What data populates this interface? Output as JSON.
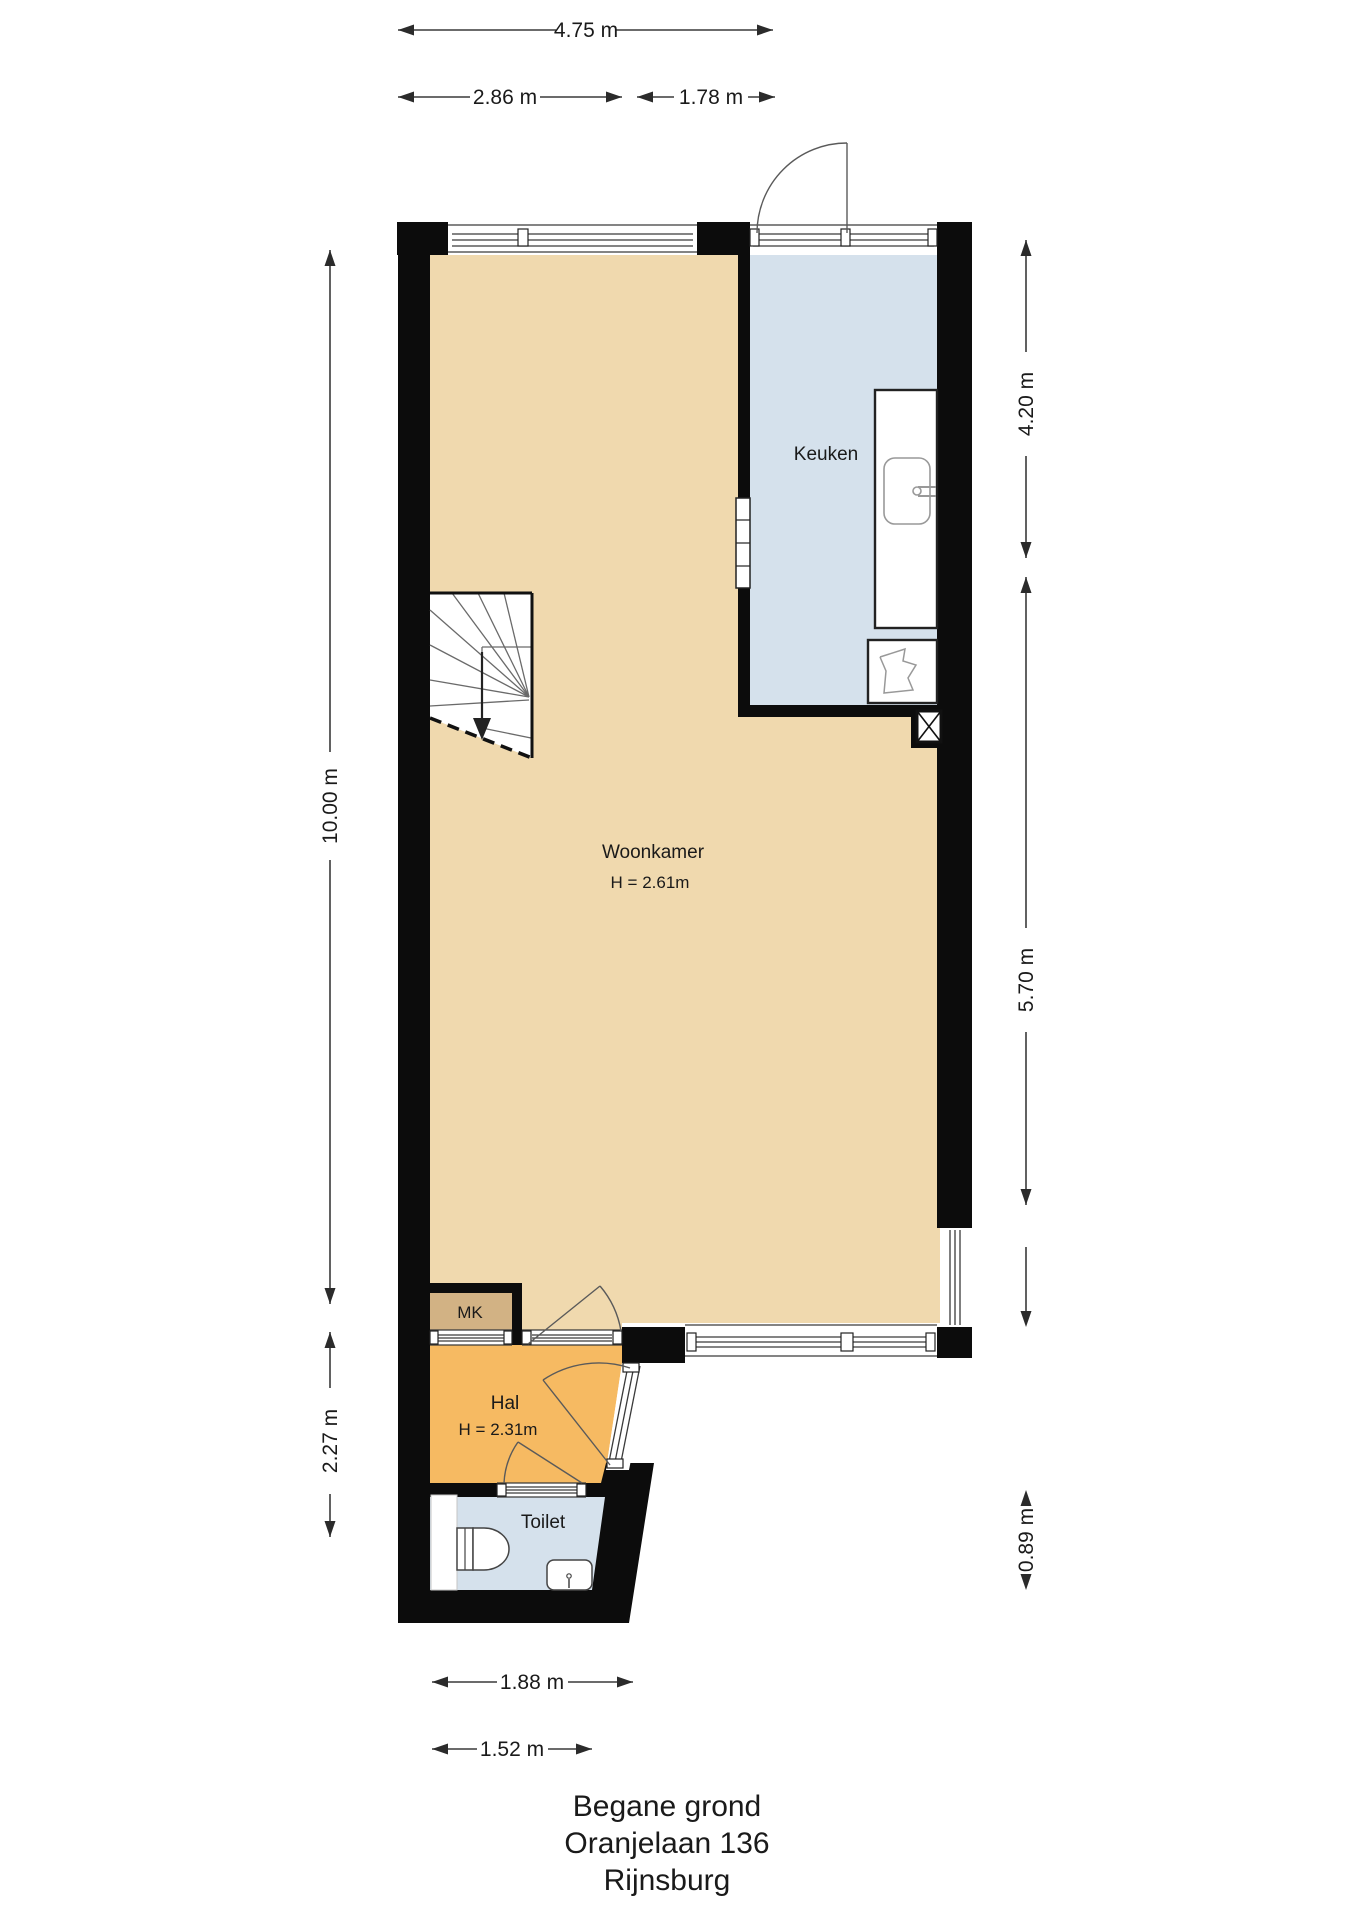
{
  "floorplan": {
    "type": "floor-plan",
    "floor_title": [
      "Begane grond",
      "Oranjelaan 136",
      "Rijnsburg"
    ],
    "rooms": {
      "keuken": {
        "label": "Keuken"
      },
      "woonkamer": {
        "label": "Woonkamer",
        "ceiling_height": "H = 2.61m"
      },
      "mk": {
        "label": "MK"
      },
      "hal": {
        "label": "Hal",
        "ceiling_height": "H = 2.31m"
      },
      "toilet": {
        "label": "Toilet"
      }
    },
    "dimensions": {
      "top_total": "4.75 m",
      "top_left_segment": "2.86 m",
      "top_right_segment": "1.78 m",
      "left_upper": "10.00 m",
      "left_lower": "2.27 m",
      "right_upper": "4.20 m",
      "right_middle": "5.70 m",
      "right_lower": "0.89 m",
      "bottom_outer": "1.88 m",
      "bottom_inner": "1.52 m"
    },
    "colors": {
      "woonkamer": "#f0d9ae",
      "keuken": "#d5e1ec",
      "toilet": "#d5e1ec",
      "hal": "#f6ba62",
      "mk": "#d2b284",
      "wall": "#0c0c0c"
    }
  }
}
